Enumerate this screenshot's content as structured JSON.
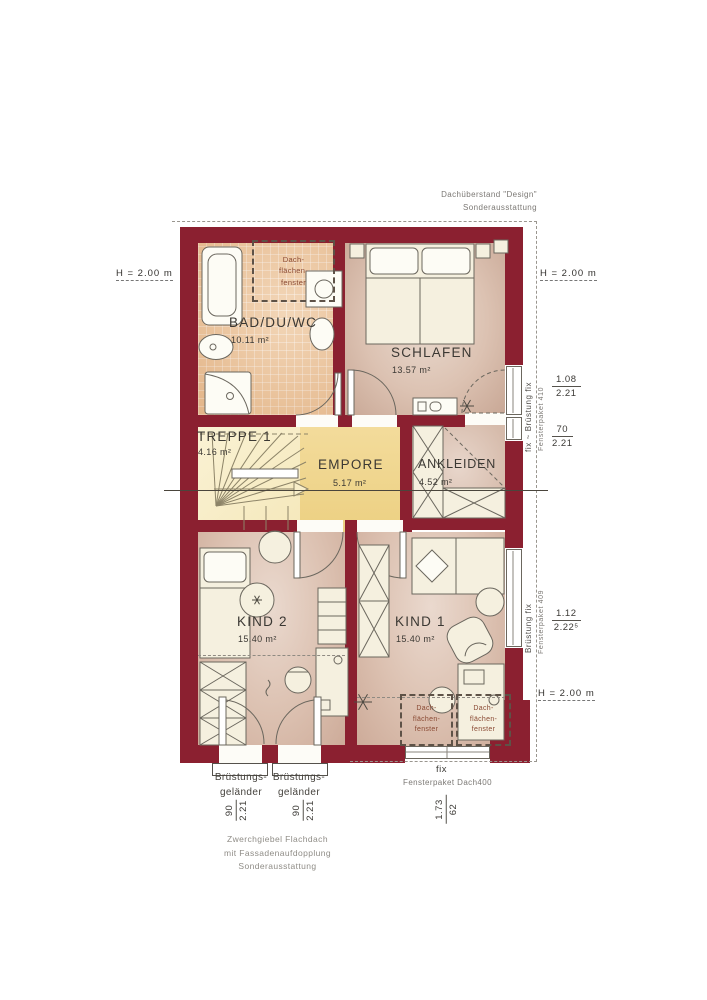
{
  "title": "Obergeschoss Grundriss",
  "palette": {
    "wall": "#8b2030",
    "empore_floor": "#eed289",
    "treppe_floor": "#f8eec9",
    "tile_floor": "#eec79d",
    "room_floor": "#dfc7ba",
    "skylight_label_color": "#8a4a34"
  },
  "rooms": {
    "bad": {
      "name": "BAD/DU/WC",
      "area": "10.11 m²"
    },
    "schlafen": {
      "name": "SCHLAFEN",
      "area": "13.57 m²"
    },
    "treppe": {
      "name": "TREPPE 1",
      "area": "4.16 m²"
    },
    "empore": {
      "name": "EMPORE",
      "area": "5.17 m²"
    },
    "ankleiden": {
      "name": "ANKLEIDEN",
      "area": "4.52 m²"
    },
    "kind2": {
      "name": "KIND 2",
      "area": "15.40 m²"
    },
    "kind1": {
      "name": "KIND 1",
      "area": "15.40 m²"
    }
  },
  "annotations": {
    "roof_overhang": "Dachüberstand \"Design\"\nSonderausstattung",
    "height": "H = 2.00 m",
    "skylight": "Dach-\nflächen-\nfenster",
    "zwerchgiebel": "Zwerchgiebel Flachdach\nmit Fassadenaufdopplung\nSonderausstattung"
  },
  "windows": {
    "right_top": {
      "label": "fix ~ Brüstung fix",
      "package": "Fensterpaket 410",
      "dim1": {
        "num": "1.08",
        "den": "2.21"
      },
      "dim2": {
        "num": "70",
        "den": "2.21"
      }
    },
    "right_bottom": {
      "label": "Brüstung fix",
      "package": "Fensterpaket 409",
      "dim": {
        "num": "1.12",
        "den": "2.22⁵"
      }
    },
    "bottom": {
      "label": "fix",
      "package": "Fensterpaket Dach400",
      "dim": {
        "num": "1.73",
        "den": "62"
      }
    }
  },
  "railings": {
    "label": "Brüstungs-\ngeländer",
    "dim": {
      "num": "90",
      "den": "2.21"
    }
  }
}
